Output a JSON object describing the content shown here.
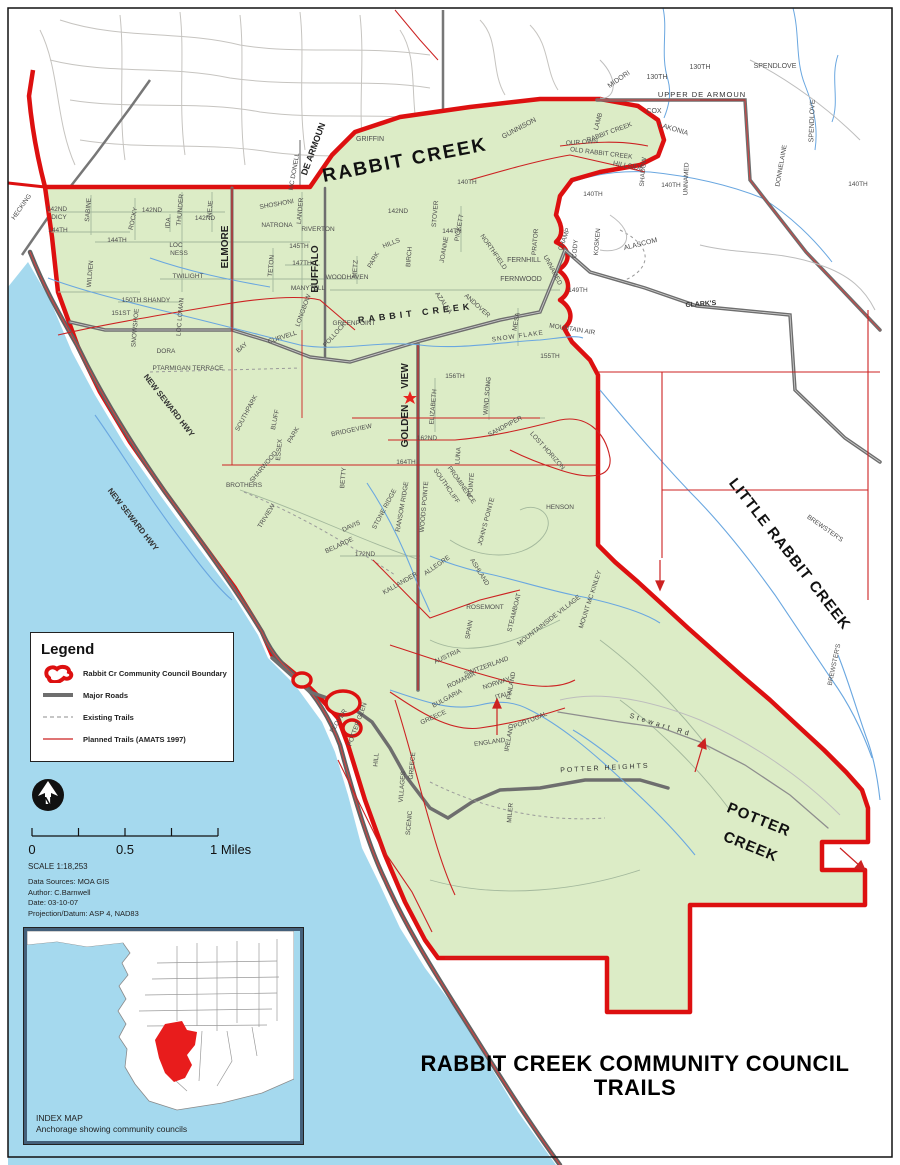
{
  "title": {
    "line1": "RABBIT CREEK COMMUNITY COUNCIL",
    "line2": "TRAILS"
  },
  "legend": {
    "title": "Legend",
    "items": [
      {
        "key": "boundary",
        "label": "Rabbit Cr Community Council Boundary"
      },
      {
        "key": "major-roads",
        "label": "Major Roads"
      },
      {
        "key": "existing-trails",
        "label": "Existing Trails"
      },
      {
        "key": "planned-trails",
        "label": "Planned Trails (AMATS 1997)"
      }
    ]
  },
  "north_arrow": {
    "label": "N"
  },
  "scale": {
    "tick0": "0",
    "tick05": "0.5",
    "tick1": "1 Miles",
    "ratio": "SCALE 1:18,253"
  },
  "notes": {
    "line1": "Data Sources: MOA GIS",
    "line2": "Author: C.Barnwell",
    "line3": "Date: 03-10-07",
    "line4": "Projection/Datum: ASP 4, NAD83"
  },
  "index_map": {
    "caption_line1": "INDEX MAP",
    "caption_line2": "Anchorage showing community councils"
  },
  "colors": {
    "council_boundary": "#DD1010",
    "council_fill": "#DCECC6",
    "water": "#A5D9EE",
    "planned_trail": "#CC2222",
    "major_road": "#6E6E6E",
    "index_highlight": "#E81C1C"
  },
  "map": {
    "labels": [
      {
        "t": "RABBIT CREEK",
        "x": 406,
        "y": 166,
        "r": -11,
        "s": 19,
        "b": 1,
        "c": "#111",
        "ls": 2
      },
      {
        "t": "LITTLE RABBIT CREEK",
        "x": 786,
        "y": 557,
        "r": 52,
        "s": 15,
        "b": 1,
        "c": "#111",
        "ls": 1
      },
      {
        "t": "POTTER",
        "x": 757,
        "y": 824,
        "r": 22,
        "s": 15,
        "b": 1,
        "c": "#111",
        "ls": 1
      },
      {
        "t": "CREEK",
        "x": 749,
        "y": 851,
        "r": 22,
        "s": 15,
        "b": 1,
        "c": "#111",
        "ls": 1
      },
      {
        "t": "ELMORE",
        "x": 228,
        "y": 247,
        "r": -90,
        "s": 10,
        "b": 1,
        "c": "#222"
      },
      {
        "t": "BUFFALO",
        "x": 318,
        "y": 269,
        "r": -90,
        "s": 10,
        "b": 1,
        "c": "#222"
      },
      {
        "t": "GOLDEN",
        "x": 408,
        "y": 426,
        "r": -90,
        "s": 10,
        "b": 1,
        "c": "#222"
      },
      {
        "t": "VIEW",
        "x": 408,
        "y": 376,
        "r": -90,
        "s": 10,
        "b": 1,
        "c": "#222"
      },
      {
        "t": "DE ARMOUN",
        "x": 316,
        "y": 150,
        "r": -70,
        "s": 9,
        "b": 1,
        "c": "#222"
      },
      {
        "t": "NEW SEWARD HWY",
        "x": 167,
        "y": 407,
        "r": 52,
        "s": 8,
        "b": 1,
        "c": "#333"
      },
      {
        "t": "NEW SEWARD HWY",
        "x": 131,
        "y": 521,
        "r": 52,
        "s": 8,
        "b": 1,
        "c": "#333"
      },
      {
        "t": "RABBIT CREEK",
        "x": 416,
        "y": 316,
        "r": -7,
        "s": 9,
        "b": 1,
        "c": "#222",
        "ls": 4
      },
      {
        "t": "UPPER DE ARMOUN",
        "x": 702,
        "y": 97,
        "s": 7.5,
        "c": "#333",
        "ls": 1
      },
      {
        "t": "CLARK'S",
        "x": 701,
        "y": 306,
        "r": -4,
        "s": 7,
        "b": 1,
        "c": "#333"
      },
      {
        "t": "POTTER HEIGHTS",
        "x": 605,
        "y": 770,
        "r": -3,
        "s": 7,
        "c": "#333",
        "ls": 2
      },
      {
        "t": "Stewart Rd",
        "x": 660,
        "y": 727,
        "r": 17,
        "s": 7,
        "c": "#333",
        "ls": 3
      },
      {
        "t": "MC DONELL",
        "x": 296,
        "y": 172,
        "r": -80,
        "s": 6.5
      },
      {
        "t": "GRIFFIN",
        "x": 370,
        "y": 141,
        "s": 7
      },
      {
        "t": "GUNNISON",
        "x": 520,
        "y": 130,
        "r": -28,
        "s": 7
      },
      {
        "t": "LAMB",
        "x": 600,
        "y": 122,
        "r": -75,
        "s": 6.5
      },
      {
        "t": "MIDORI",
        "x": 620,
        "y": 81,
        "r": -35,
        "s": 7
      },
      {
        "t": "130TH",
        "x": 657,
        "y": 79,
        "s": 7
      },
      {
        "t": "130TH",
        "x": 700,
        "y": 69,
        "s": 7
      },
      {
        "t": "SPENDLOVE",
        "x": 775,
        "y": 68,
        "s": 7
      },
      {
        "t": "SPENDLOVE",
        "x": 814,
        "y": 121,
        "r": -88,
        "s": 7
      },
      {
        "t": "COX",
        "x": 654,
        "y": 113,
        "s": 7
      },
      {
        "t": "LAKONIA",
        "x": 673,
        "y": 131,
        "r": 17,
        "s": 7
      },
      {
        "t": "RABBIT CREEK",
        "x": 610,
        "y": 134,
        "r": -20,
        "s": 6.5
      },
      {
        "t": "DONNELAINE",
        "x": 783,
        "y": 166,
        "r": -80,
        "s": 6.5
      },
      {
        "t": "UNNAMED",
        "x": 688,
        "y": 179,
        "r": -88,
        "s": 6.5
      },
      {
        "t": "UNNAMED",
        "x": 551,
        "y": 271,
        "r": 62,
        "s": 6.5
      },
      {
        "t": "ALASCOM",
        "x": 641,
        "y": 246,
        "r": -14,
        "s": 7
      },
      {
        "t": "140TH",
        "x": 467,
        "y": 184,
        "s": 6.5
      },
      {
        "t": "140TH",
        "x": 593,
        "y": 196,
        "s": 6.5
      },
      {
        "t": "140TH",
        "x": 671,
        "y": 187,
        "s": 6.5
      },
      {
        "t": "140TH",
        "x": 858,
        "y": 186,
        "s": 6.5
      },
      {
        "t": "HILLSIDE",
        "x": 628,
        "y": 168,
        "r": 10,
        "s": 7
      },
      {
        "t": "SHADOW",
        "x": 645,
        "y": 172,
        "r": -85,
        "s": 6.5
      },
      {
        "t": "OUR OWN",
        "x": 582,
        "y": 144,
        "r": -4,
        "s": 6.5
      },
      {
        "t": "OLD RABBIT CREEK",
        "x": 601,
        "y": 155,
        "r": 7,
        "s": 6.5
      },
      {
        "t": "PRATOR",
        "x": 537,
        "y": 242,
        "r": -85,
        "s": 6.5
      },
      {
        "t": "CHAMP",
        "x": 566,
        "y": 240,
        "r": -70,
        "s": 6.5
      },
      {
        "t": "CODY",
        "x": 577,
        "y": 249,
        "r": -85,
        "s": 6.5
      },
      {
        "t": "KOSKEN",
        "x": 599,
        "y": 242,
        "r": -85,
        "s": 6.5
      },
      {
        "t": "149TH",
        "x": 578,
        "y": 292,
        "s": 6.5
      },
      {
        "t": "MOUNTAIN AIR",
        "x": 572,
        "y": 331,
        "r": 9,
        "s": 6.5
      },
      {
        "t": "FERNHILL",
        "x": 524,
        "y": 262,
        "s": 7
      },
      {
        "t": "FERNWOOD",
        "x": 521,
        "y": 281,
        "s": 7
      },
      {
        "t": "MESA",
        "x": 518,
        "y": 322,
        "r": -80,
        "s": 6.5
      },
      {
        "t": "SNOW FLAKE",
        "x": 518,
        "y": 338,
        "r": -8,
        "s": 6.5,
        "ls": 1
      },
      {
        "t": "155TH",
        "x": 550,
        "y": 358,
        "s": 6.5
      },
      {
        "t": "156TH",
        "x": 455,
        "y": 378,
        "s": 6.5
      },
      {
        "t": "162ND",
        "x": 427,
        "y": 440,
        "s": 6.5
      },
      {
        "t": "164TH",
        "x": 406,
        "y": 464,
        "s": 6.5
      },
      {
        "t": "142ND",
        "x": 57,
        "y": 211,
        "s": 6.5
      },
      {
        "t": "DICY",
        "x": 59,
        "y": 219,
        "s": 6.5
      },
      {
        "t": "144TH",
        "x": 58,
        "y": 232,
        "s": 6.5
      },
      {
        "t": "SABINE",
        "x": 90,
        "y": 210,
        "r": -85,
        "s": 6.5
      },
      {
        "t": "WILDIEN",
        "x": 92,
        "y": 274,
        "r": -85,
        "s": 6.5
      },
      {
        "t": "ROCKY",
        "x": 135,
        "y": 219,
        "r": -78,
        "s": 6.5
      },
      {
        "t": "142ND",
        "x": 152,
        "y": 212,
        "s": 6.5
      },
      {
        "t": "IDA",
        "x": 170,
        "y": 223,
        "r": -85,
        "s": 6.5
      },
      {
        "t": "THUNDER",
        "x": 182,
        "y": 210,
        "r": -85,
        "s": 6.5
      },
      {
        "t": "NEJE",
        "x": 212,
        "y": 209,
        "r": -85,
        "s": 6.5
      },
      {
        "t": "142ND",
        "x": 205,
        "y": 220,
        "s": 6.5
      },
      {
        "t": "142ND",
        "x": 398,
        "y": 213,
        "s": 6.5
      },
      {
        "t": "144TH",
        "x": 117,
        "y": 242,
        "s": 6.5
      },
      {
        "t": "LOC",
        "x": 176,
        "y": 247,
        "s": 6.5
      },
      {
        "t": "NESS",
        "x": 179,
        "y": 255,
        "s": 6.5
      },
      {
        "t": "TWILIGHT",
        "x": 188,
        "y": 278,
        "s": 6.5
      },
      {
        "t": "150TH SHANDY",
        "x": 146,
        "y": 302,
        "s": 6.5
      },
      {
        "t": "151ST",
        "x": 121,
        "y": 315,
        "s": 6.5
      },
      {
        "t": "SNOWSHOE",
        "x": 137,
        "y": 328,
        "r": -85,
        "s": 6.5
      },
      {
        "t": "LOC LOMAN",
        "x": 182,
        "y": 317,
        "r": -85,
        "s": 6.5
      },
      {
        "t": "DORA",
        "x": 166,
        "y": 353,
        "s": 6.5
      },
      {
        "t": "PTARMIGAN TERRACE",
        "x": 188,
        "y": 370,
        "s": 6.5
      },
      {
        "t": "SHOSHONI",
        "x": 277,
        "y": 206,
        "r": -10,
        "s": 6.5
      },
      {
        "t": "NATRONA",
        "x": 277,
        "y": 227,
        "s": 6.5
      },
      {
        "t": "LANDER",
        "x": 302,
        "y": 211,
        "r": -85,
        "s": 6.5
      },
      {
        "t": "RIVERTON",
        "x": 318,
        "y": 231,
        "s": 6.5
      },
      {
        "t": "145TH",
        "x": 299,
        "y": 248,
        "s": 6.5
      },
      {
        "t": "147TH",
        "x": 302,
        "y": 265,
        "s": 6.5
      },
      {
        "t": "TETON",
        "x": 273,
        "y": 266,
        "r": -85,
        "s": 6.5
      },
      {
        "t": "MANYTELL",
        "x": 308,
        "y": 290,
        "s": 6.5
      },
      {
        "t": "LONGBOW",
        "x": 305,
        "y": 311,
        "r": -70,
        "s": 6.5
      },
      {
        "t": "CURVELL",
        "x": 283,
        "y": 339,
        "r": -18,
        "s": 6.5
      },
      {
        "t": "BAY",
        "x": 243,
        "y": 349,
        "r": -40,
        "s": 6.5
      },
      {
        "t": "GREENPOINT",
        "x": 354,
        "y": 325,
        "s": 6.5
      },
      {
        "t": "POLLOCK",
        "x": 336,
        "y": 336,
        "r": -48,
        "s": 6.5
      },
      {
        "t": "WOODHAVEN",
        "x": 347,
        "y": 279,
        "s": 6.5
      },
      {
        "t": "METZ",
        "x": 357,
        "y": 269,
        "r": -85,
        "s": 6.5
      },
      {
        "t": "PARK",
        "x": 375,
        "y": 261,
        "r": -60,
        "s": 6.5
      },
      {
        "t": "HILLS",
        "x": 392,
        "y": 245,
        "r": -22,
        "s": 6.5
      },
      {
        "t": "BIRCH",
        "x": 411,
        "y": 257,
        "r": -85,
        "s": 6.5
      },
      {
        "t": "144TH",
        "x": 452,
        "y": 233,
        "s": 6.5
      },
      {
        "t": "JOANNE",
        "x": 446,
        "y": 250,
        "r": -80,
        "s": 6.5
      },
      {
        "t": "PICKETT",
        "x": 461,
        "y": 228,
        "r": -80,
        "s": 6.5
      },
      {
        "t": "STOVER",
        "x": 437,
        "y": 214,
        "r": -85,
        "s": 6.5
      },
      {
        "t": "NORTHFIELD",
        "x": 492,
        "y": 253,
        "r": 55,
        "s": 6.5
      },
      {
        "t": "AZALEA",
        "x": 442,
        "y": 304,
        "r": 55,
        "s": 6.5
      },
      {
        "t": "ANDOVER",
        "x": 476,
        "y": 307,
        "r": 42,
        "s": 6.5
      },
      {
        "t": "WIND SONG",
        "x": 489,
        "y": 396,
        "r": -85,
        "s": 6.5
      },
      {
        "t": "ELIZABETH",
        "x": 435,
        "y": 407,
        "r": -85,
        "s": 6.5
      },
      {
        "t": "SANDPIPER",
        "x": 506,
        "y": 428,
        "r": -28,
        "s": 6.5
      },
      {
        "t": "LOST HORIZON",
        "x": 546,
        "y": 452,
        "r": 48,
        "s": 6.5
      },
      {
        "t": "BRIDGEVIEW",
        "x": 352,
        "y": 432,
        "r": -12,
        "s": 6.5
      },
      {
        "t": "LUNA",
        "x": 460,
        "y": 456,
        "r": -85,
        "s": 6.5
      },
      {
        "t": "BETTY",
        "x": 345,
        "y": 478,
        "r": -85,
        "s": 6.5
      },
      {
        "t": "SOUTHCLIFF",
        "x": 445,
        "y": 487,
        "r": 55,
        "s": 6.5
      },
      {
        "t": "PROMINENCE",
        "x": 460,
        "y": 486,
        "r": 55,
        "s": 6.5
      },
      {
        "t": "POINTE",
        "x": 473,
        "y": 485,
        "r": -85,
        "s": 6.5
      },
      {
        "t": "JOHN'S POINTE",
        "x": 488,
        "y": 522,
        "r": -75,
        "s": 6.5
      },
      {
        "t": "WOODS POINTE",
        "x": 426,
        "y": 507,
        "r": -85,
        "s": 6.5
      },
      {
        "t": "RANSOM RIDGE",
        "x": 404,
        "y": 507,
        "r": -80,
        "s": 6.5
      },
      {
        "t": "STONE RIDGE",
        "x": 386,
        "y": 510,
        "r": -62,
        "s": 6.5
      },
      {
        "t": "DAVIS",
        "x": 352,
        "y": 528,
        "r": -25,
        "s": 6.5
      },
      {
        "t": "BELARDE",
        "x": 340,
        "y": 547,
        "r": -25,
        "s": 6.5
      },
      {
        "t": "172ND",
        "x": 365,
        "y": 556,
        "s": 6.5
      },
      {
        "t": "KALLANDER",
        "x": 401,
        "y": 585,
        "r": -30,
        "s": 6.5
      },
      {
        "t": "ALLEGRE",
        "x": 438,
        "y": 567,
        "r": -35,
        "s": 6.5
      },
      {
        "t": "ASHLAND",
        "x": 478,
        "y": 573,
        "r": 58,
        "s": 6.5
      },
      {
        "t": "ROSEMONT",
        "x": 485,
        "y": 609,
        "s": 6.5
      },
      {
        "t": "SPAIN",
        "x": 471,
        "y": 630,
        "r": -80,
        "s": 6.5
      },
      {
        "t": "STEAMBOAT",
        "x": 516,
        "y": 613,
        "r": -76,
        "s": 6.5
      },
      {
        "t": "MOUNTAINSIDE VILLAGE",
        "x": 550,
        "y": 622,
        "r": -38,
        "s": 6.5
      },
      {
        "t": "MOUNT MC KINLEY",
        "x": 592,
        "y": 600,
        "r": -72,
        "s": 6.5
      },
      {
        "t": "HENSON",
        "x": 560,
        "y": 509,
        "s": 6.5
      },
      {
        "t": "AUSTRIA",
        "x": 448,
        "y": 658,
        "r": -24,
        "s": 6.5
      },
      {
        "t": "SWITZERLAND",
        "x": 487,
        "y": 668,
        "r": -20,
        "s": 6.5
      },
      {
        "t": "ROMANIA",
        "x": 462,
        "y": 682,
        "r": -26,
        "s": 6.5
      },
      {
        "t": "NORWAY",
        "x": 497,
        "y": 685,
        "r": -18,
        "s": 6.5
      },
      {
        "t": "BULGARIA",
        "x": 448,
        "y": 700,
        "r": -28,
        "s": 6.5
      },
      {
        "t": "ITALY",
        "x": 504,
        "y": 697,
        "r": -15,
        "s": 6.5
      },
      {
        "t": "FINLAND",
        "x": 513,
        "y": 686,
        "r": -80,
        "s": 6.5
      },
      {
        "t": "GREECE",
        "x": 434,
        "y": 719,
        "r": -24,
        "s": 6.5
      },
      {
        "t": "GREECE",
        "x": 414,
        "y": 766,
        "r": -85,
        "s": 6.5
      },
      {
        "t": "PORTUGAL",
        "x": 531,
        "y": 722,
        "r": -22,
        "s": 6.5
      },
      {
        "t": "ENGLAND",
        "x": 490,
        "y": 744,
        "r": -8,
        "s": 6.5
      },
      {
        "t": "IRELAND",
        "x": 511,
        "y": 738,
        "r": -80,
        "s": 6.5
      },
      {
        "t": "VILLAGES",
        "x": 404,
        "y": 787,
        "r": -85,
        "s": 6.5
      },
      {
        "t": "SCENIC",
        "x": 411,
        "y": 823,
        "r": -85,
        "s": 6.5
      },
      {
        "t": "MILER",
        "x": 512,
        "y": 813,
        "r": -85,
        "s": 6.5
      },
      {
        "t": "HILL",
        "x": 378,
        "y": 760,
        "r": -85,
        "s": 6.5
      },
      {
        "t": "PLOVER",
        "x": 340,
        "y": 722,
        "r": -58,
        "s": 6.5
      },
      {
        "t": "POTTER GLEN",
        "x": 359,
        "y": 725,
        "r": -70,
        "s": 6.5
      },
      {
        "t": "TRIVIEW",
        "x": 268,
        "y": 517,
        "r": -58,
        "s": 6.5
      },
      {
        "t": "BROTHERS",
        "x": 244,
        "y": 487,
        "s": 6.5
      },
      {
        "t": "SOUTHPARK",
        "x": 248,
        "y": 414,
        "r": -62,
        "s": 6.5
      },
      {
        "t": "BLUFF",
        "x": 277,
        "y": 420,
        "r": -78,
        "s": 6.5
      },
      {
        "t": "ESSEX",
        "x": 281,
        "y": 450,
        "r": -85,
        "s": 6.5
      },
      {
        "t": "PARK",
        "x": 295,
        "y": 436,
        "r": -60,
        "s": 6.5
      },
      {
        "t": "SHARWOOD",
        "x": 265,
        "y": 468,
        "r": -50,
        "s": 6.5
      },
      {
        "t": "BREWSTER'S",
        "x": 824,
        "y": 530,
        "r": 35,
        "s": 6.5
      },
      {
        "t": "BREWSTER'S",
        "x": 836,
        "y": 665,
        "r": -78,
        "s": 6.5
      },
      {
        "t": "HECKING",
        "x": 23,
        "y": 208,
        "r": -55,
        "s": 6.5
      }
    ]
  }
}
